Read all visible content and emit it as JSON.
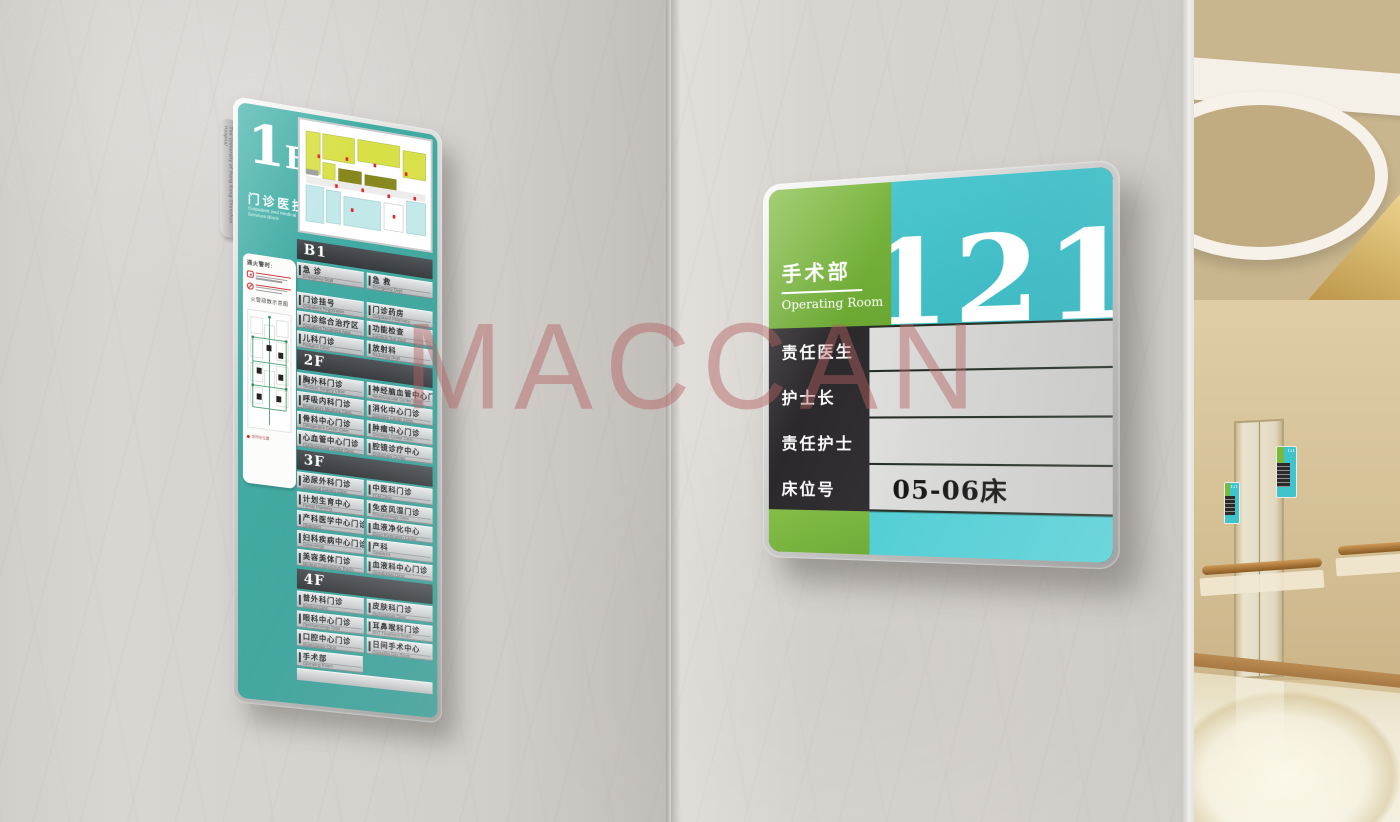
{
  "watermark": {
    "text": "MACCAN"
  },
  "colors": {
    "directory_teal": "#3aa49c",
    "room_green": "#74b73c",
    "room_teal": "#3fc3cb",
    "dark_band": "#3c4043",
    "black_panel": "#2b292b",
    "frame_silver": "#c9cac8",
    "watermark_pink": "#b26262"
  },
  "directory_sign": {
    "side_tab_text": "The University of Hong Kong Shenzhen Hospital",
    "floor_big": "1",
    "floor_small": "F",
    "title_zh": "门诊医技楼",
    "title_en_line1": "Outpatient and Medical",
    "title_en_line2": "Services Block",
    "fire_panel": {
      "heading": "遇火警时:",
      "map_title": "火警疏散示意图",
      "legend": "您所在位置"
    },
    "sections": [
      {
        "label": "B1",
        "rows": [
          [
            {
              "zh": "急 诊",
              "en": "Emergency Dept"
            },
            {
              "zh": "急 救",
              "en": "Emergency Dept"
            }
          ]
        ]
      },
      {
        "label": "",
        "rows": [
          [
            {
              "zh": "门诊挂号",
              "en": "Outpatient Registration"
            },
            {
              "zh": "门诊药房",
              "en": "Outpatient Pharmacy"
            }
          ],
          [
            {
              "zh": "门诊综合治疗区",
              "en": "Outpatient Treatment Area"
            },
            {
              "zh": "功能检查",
              "en": "Function Test Dept"
            }
          ],
          [
            {
              "zh": "儿科门诊",
              "en": "Pediatric Clinic"
            },
            {
              "zh": "放射科",
              "en": "Radiology Dept"
            }
          ]
        ]
      },
      {
        "label": "2F",
        "rows": [
          [
            {
              "zh": "胸外科门诊",
              "en": "Thoracic Surgery Clinic"
            },
            {
              "zh": "神经脑血管中心门诊",
              "en": "Neurovascular Center Clinic"
            }
          ],
          [
            {
              "zh": "呼吸内科门诊",
              "en": "Respiratory Medicine Clinic"
            },
            {
              "zh": "消化中心门诊",
              "en": "Digestive Center Clinic"
            }
          ],
          [
            {
              "zh": "骨科中心门诊",
              "en": "Orthopedics Center Clinic"
            },
            {
              "zh": "肿瘤中心门诊",
              "en": "Oncology Center Clinic"
            }
          ],
          [
            {
              "zh": "心血管中心门诊",
              "en": "Cardiovascular Center Clinic"
            },
            {
              "zh": "腔镜诊疗中心",
              "en": "Endoscopy Center"
            }
          ]
        ]
      },
      {
        "label": "3F",
        "rows": [
          [
            {
              "zh": "泌尿外科门诊",
              "en": "Urological Surgery Clinic"
            },
            {
              "zh": "中医科门诊",
              "en": "TCM Clinic"
            }
          ],
          [
            {
              "zh": "计划生育中心",
              "en": "Family Planning"
            },
            {
              "zh": "免疫风湿门诊",
              "en": "Rheumatology Clinic"
            }
          ],
          [
            {
              "zh": "产科医学中心门诊",
              "en": "Obstetrics"
            },
            {
              "zh": "血液净化中心",
              "en": "Blood Purification Center"
            }
          ],
          [
            {
              "zh": "妇科疾病中心门诊",
              "en": "Gynecology"
            },
            {
              "zh": "产科",
              "en": "Obstetrics"
            }
          ],
          [
            {
              "zh": "美容美体门诊",
              "en": "Medical Cosmetology Room"
            },
            {
              "zh": "血液科中心门诊",
              "en": "Hematology Clinic"
            }
          ]
        ]
      },
      {
        "label": "4F",
        "rows": [
          [
            {
              "zh": "普外科门诊",
              "en": "Surgical Clinic"
            },
            {
              "zh": "皮肤科门诊",
              "en": "Dermatology Clinic"
            }
          ],
          [
            {
              "zh": "眼科中心门诊",
              "en": "Ophthalmology Dept"
            },
            {
              "zh": "耳鼻喉科门诊",
              "en": "ENT Treatment Room"
            }
          ],
          [
            {
              "zh": "口腔中心门诊",
              "en": "Stomatology Clinic"
            },
            {
              "zh": "日间手术中心",
              "en": "Operating Day Room"
            }
          ],
          [
            {
              "zh": "手术部",
              "en": "Operating Room"
            }
          ]
        ]
      }
    ]
  },
  "room_sign": {
    "dept_zh": "手术部",
    "dept_en": "Operating Room",
    "room_number": "121",
    "fields": [
      {
        "label": "责任医生",
        "value": ""
      },
      {
        "label": "护士长",
        "value": ""
      },
      {
        "label": "责任护士",
        "value": ""
      },
      {
        "label": "床位号",
        "value": "05-06床"
      }
    ]
  },
  "hallway": {
    "mini_sign_number": "121"
  }
}
